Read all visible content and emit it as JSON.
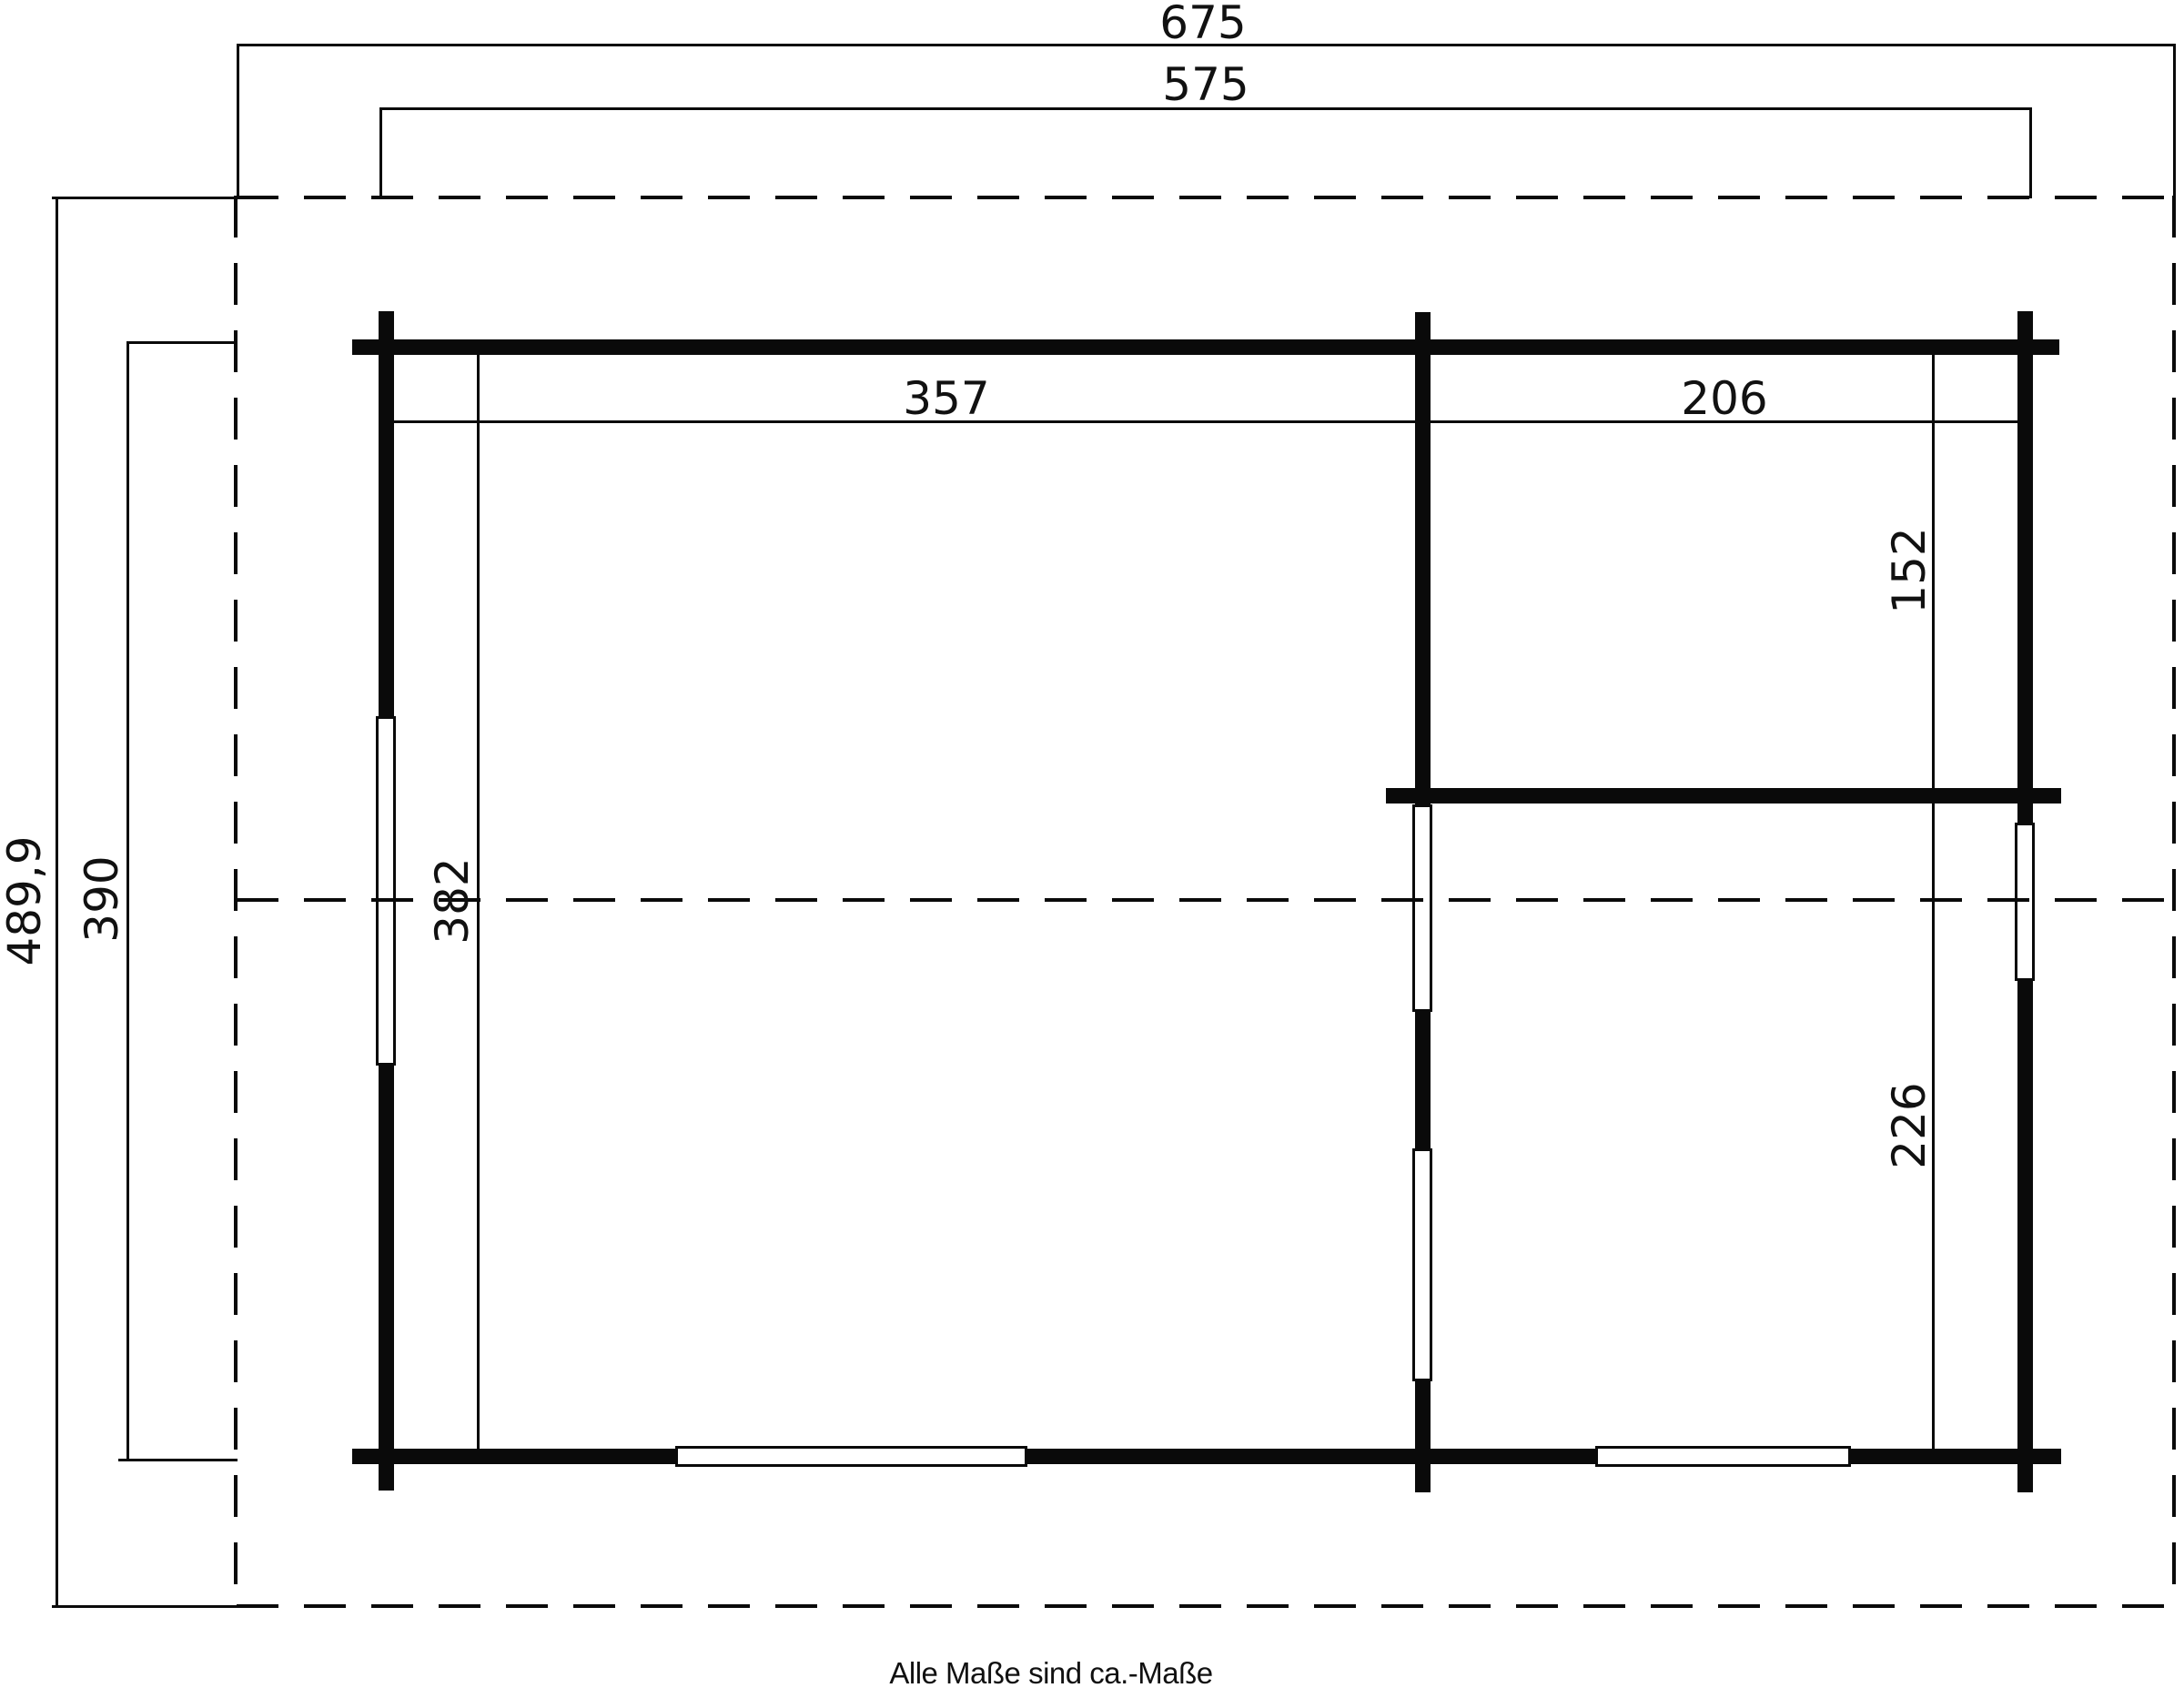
{
  "plan": {
    "caption": "Alle Maße sind ca.-Maße",
    "colors": {
      "line": "#0a0a0a",
      "background": "#ffffff"
    },
    "dimensions": {
      "overall_width": "675",
      "building_width": "575",
      "overall_depth": "489,9",
      "building_depth": "390",
      "left_room_width": "357",
      "right_room_width": "206",
      "left_room_depth": "382",
      "right_top_room_depth": "152",
      "right_bottom_room_depth": "226"
    }
  }
}
